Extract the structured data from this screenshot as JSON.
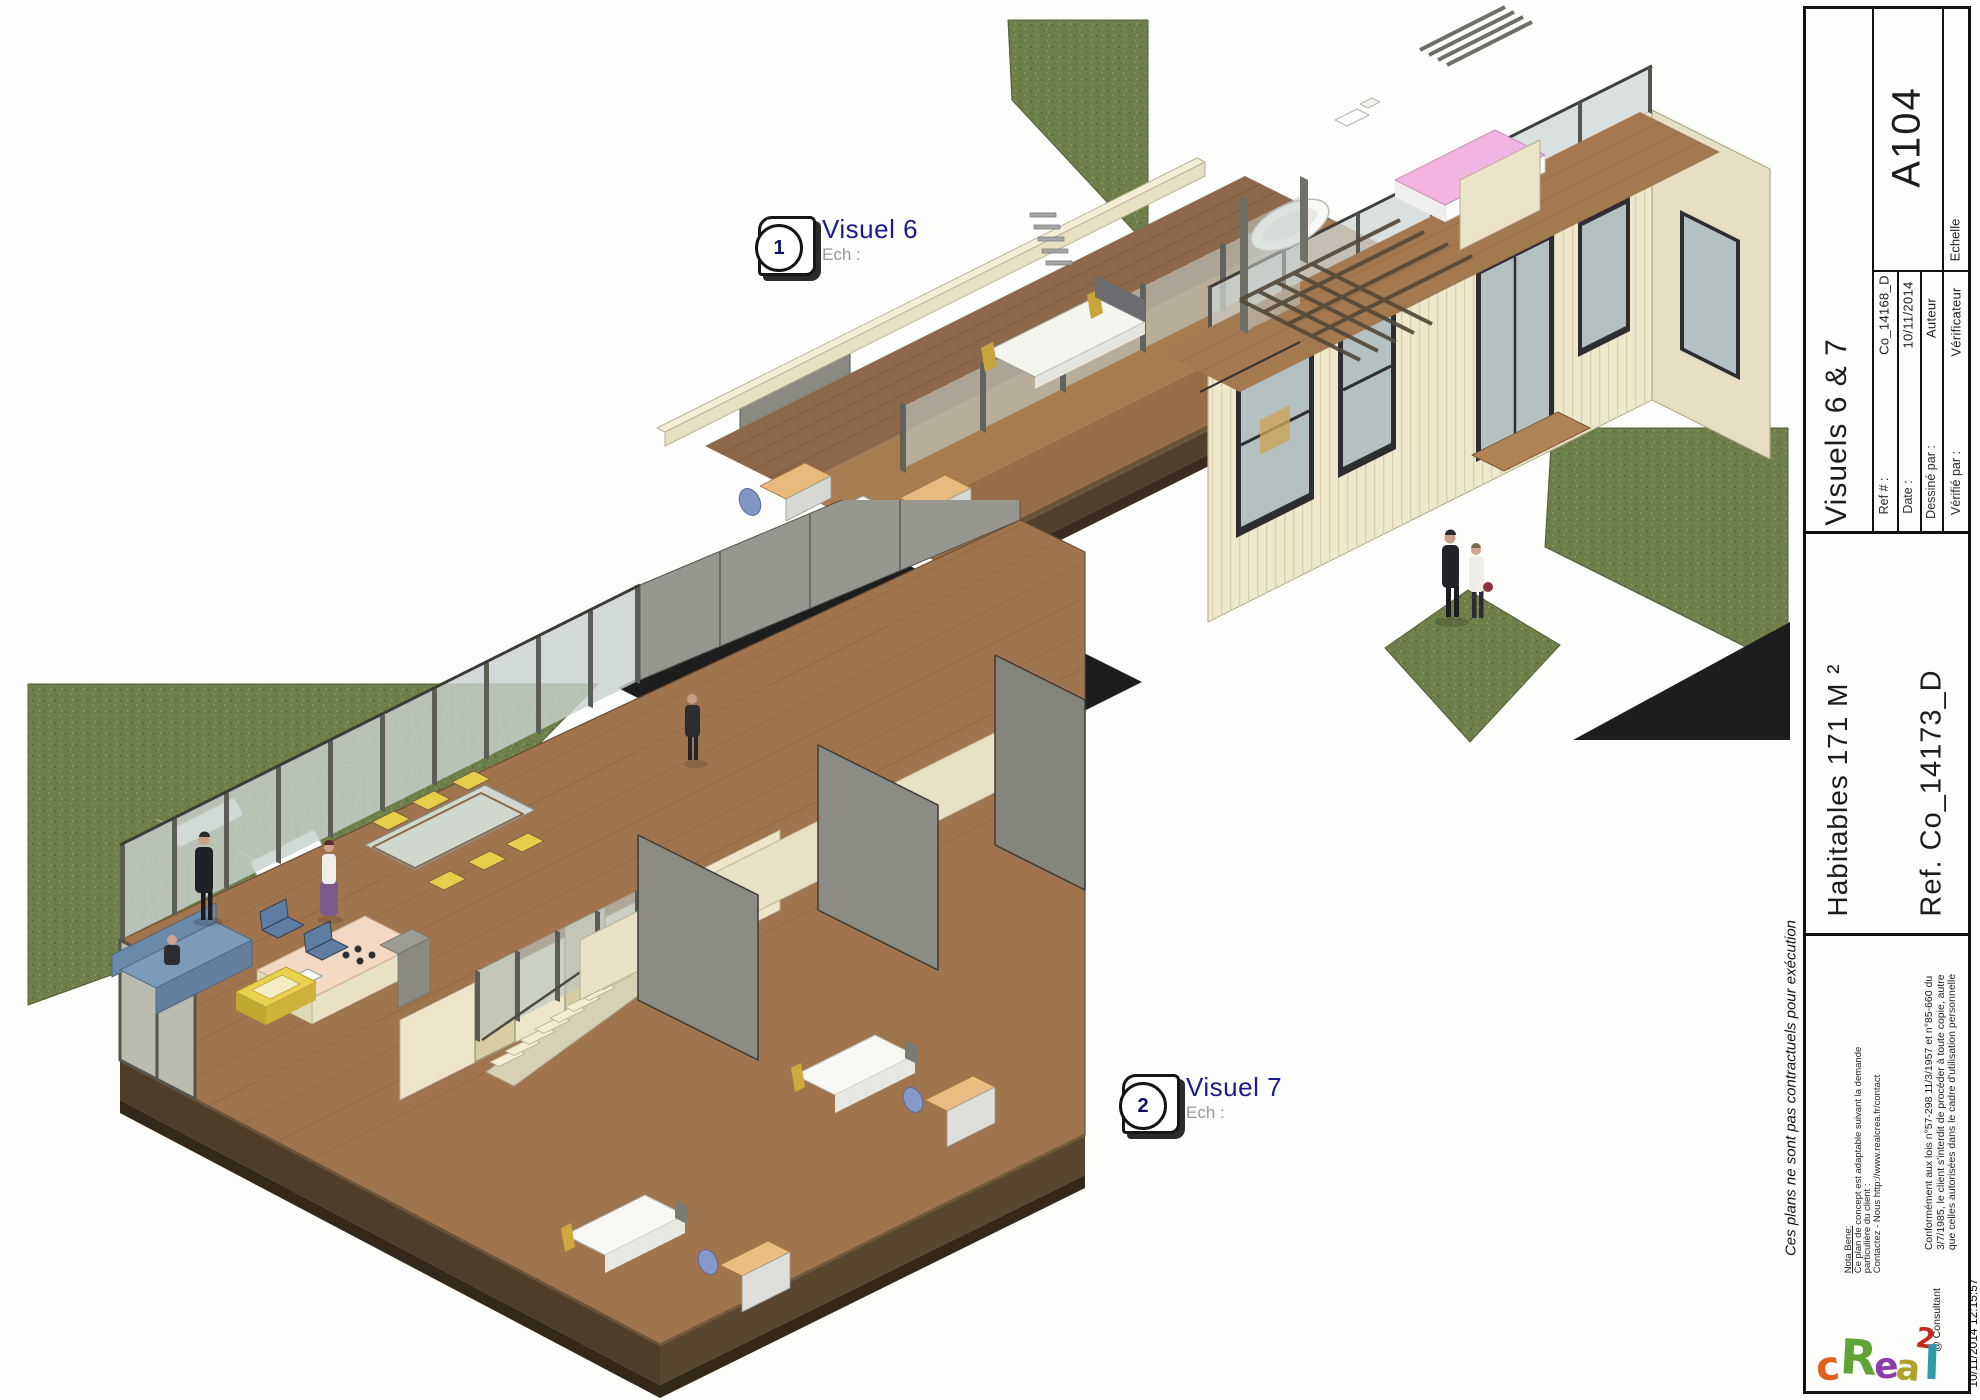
{
  "sheet": {
    "side_note": "Ces plans ne sont pas contractuels pour exécution",
    "print_timestamp": "10/11/2014 12:15:57"
  },
  "views": [
    {
      "number": "1",
      "title": "Visuel 6",
      "scale_label": "Ech :"
    },
    {
      "number": "2",
      "title": "Visuel 7",
      "scale_label": "Ech :"
    }
  ],
  "titleblock": {
    "sheet_number": "A104",
    "sheet_title": "Visuels 6 & 7",
    "scale_header": "Echelle",
    "fields": [
      {
        "label": "Ref # :",
        "value": "Co_14168_D"
      },
      {
        "label": "Date :",
        "value": "10/11/2014"
      },
      {
        "label": "Dessiné par :",
        "value": "Auteur"
      },
      {
        "label": "Vérifié par :",
        "value": "Vérificateur"
      }
    ],
    "area_line": "Habitables 171 M ²",
    "reference_line": "Ref. Co_14173_D",
    "nota_bene": {
      "heading": "Nota Bene:",
      "lines": [
        "Ce plan de concept est adaptable suivant la demande",
        "particulière du client :",
        "Contactez - Nous http://www.realcrea.fr/contact"
      ]
    },
    "legal_lines": [
      "Conformément aux lois n°57-298 11/3/1957 et n°85-660 du",
      "3/7/1985, le client s'interdit de procéder à toute copie, autre",
      "que celles autorisées dans le cadre d'utilisation personnelle"
    ],
    "consultant": "@ Consultant",
    "logo": {
      "text": "cRea2l",
      "letters": [
        {
          "ch": "c",
          "color": "#e0611c"
        },
        {
          "ch": "R",
          "color": "#5fa235"
        },
        {
          "ch": "e",
          "color": "#8a3fa8"
        },
        {
          "ch": "a",
          "color": "#b0a127"
        },
        {
          "ch": "2",
          "color": "#c8281e"
        },
        {
          "ch": "l",
          "color": "#2e9aaa"
        }
      ]
    }
  },
  "colors": {
    "label_navy": "#1b1b8c",
    "muted_gray": "#98989a",
    "grass_green": "#6e7f49",
    "wood_deck": "#8d684a",
    "wood_floor": "#a0744c",
    "wall_cream": "#f0e8cd",
    "partition_gray": "#8c8c83",
    "plinth_brown": "#4f3c29",
    "road_black": "#1d1d1d",
    "bed_pink": "#f2b4e2",
    "sofa_blue": "#7d9ab6",
    "chair_yellow": "#e6ce4a"
  }
}
